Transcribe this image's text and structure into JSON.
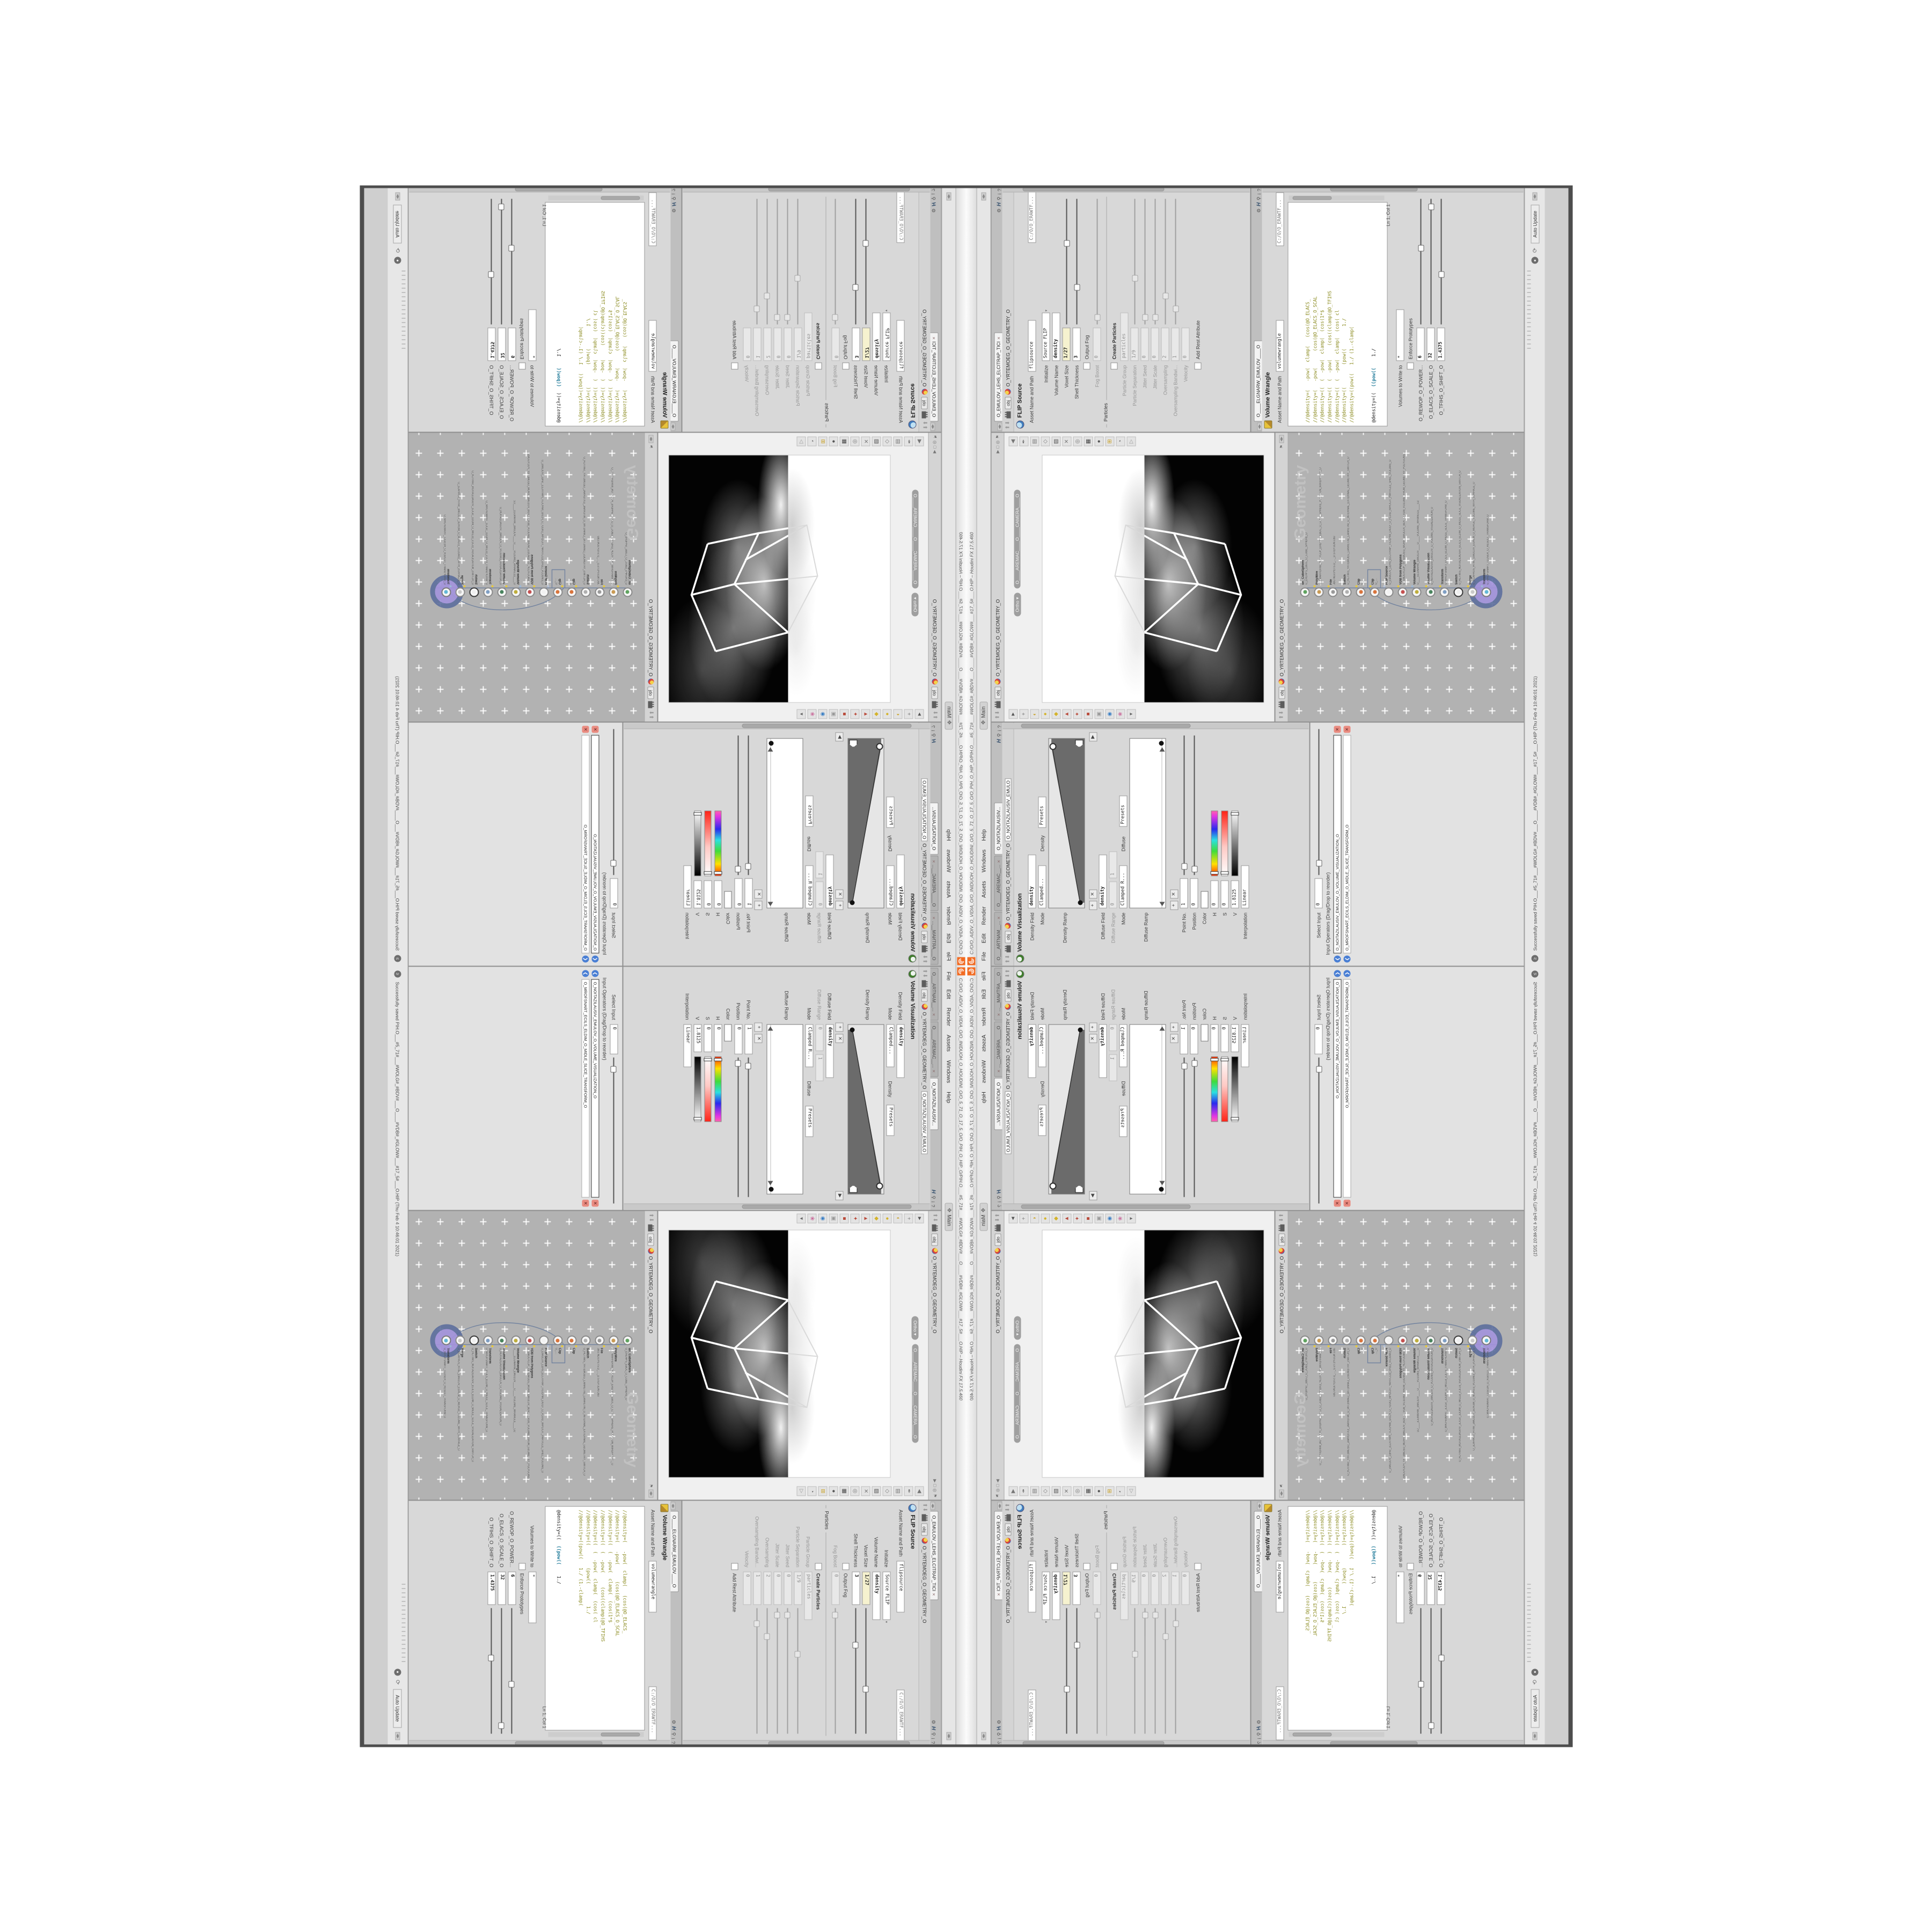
{
  "window": {
    "title": "C:/O/O_AIDIV_O_VIDIA_O/O_INIDUOH_O_HOUDINI_O/O_5_71_O_17_5_O/O_PIH_O_HIP_O/PIH.O___#5_71#___#WOLG#_#BDV#___O____#VDB#_#GLOW#___#17_5#___O.HIP – Houdini FX 17.5.460",
    "menu": [
      "File",
      "Edit",
      "Render",
      "Assets",
      "Windows",
      "Help"
    ],
    "desktop": "Main"
  },
  "status": {
    "message": "Successfully saved PIH.O___#5_71#___#WOLG#_#BDV#___O____#VDB#_#GLOW#___#17_5#___O.HIP (Thu Feb 4 10:46:01 2021)",
    "auto_update": "Auto Update"
  },
  "scene": {
    "context_tab": "obj",
    "path": "O_YRTEMOEG_O_GEOMETRY_O",
    "view_mode": "Ortho",
    "camera": "O____AREMAC____O____CAMERA____O"
  },
  "network": {
    "context_tab": "obj",
    "path": "O_YRTEMOEG_O_GEOMETRY_O",
    "watermark": "Geometry",
    "nodes": [
      {
        "t": "un_CubeSphere",
        "n": "O_EREHPS_EBUC_O_CUBE_SPHERE_O",
        "c": "#5fa35f",
        "ring": "#8a8a8a",
        "badge": "transparent"
      },
      {
        "t": "PolyWire",
        "n": "O_EMARFERIW_NOGYLOP_EREHPS_EBUC_O_CUBE_SPHERE_POLYGON_WIREFRAME_O",
        "c": "#c99a53",
        "ring": "#8a8a8a",
        "badge": "#e8c93a"
      },
      {
        "t": "File",
        "n": "JBO.ND3.PETS.D_…_D.STEP.3DN.OBJ",
        "c": "#9a9a9a",
        "ring": "#8a8a8a",
        "badge": "#e8c93a"
      },
      {
        "t": "Switch",
        "n": "O_HCTIWS_YRTEMOEG_LANRETXE_LANRETNI_O_INTERNAL_EXTERNAL_GEOMETRY_SWITCH_O",
        "c": "#b0b0b0",
        "ring": "#8a8a8a",
        "badge": "transparent"
      },
      {
        "t": "Clip",
        "n": "O_…",
        "c": "#d9743c",
        "ring": "#8a8a8a",
        "badge": "#e8c93a"
      },
      {
        "t": "Clip",
        "n": "O_…",
        "c": "#d9743c",
        "ring": "#8a8a8a",
        "badge": "#e8c93a"
      },
      {
        "t": "FLIP Source",
        "n": "O_EMULOV_LEHS_ELCITRAP_TICILPMI_DIULF_O_FLUID_IMPLICIT_PARTICLE_SHEL_VOLUME_O",
        "c": "#f2f2f2",
        "ring": "#8a8a8a",
        "badge": "#b8c4d8"
      },
      {
        "t": "VDB from Polygons",
        "n": "O_SNOGYLOP_YRTEMOEG_MORF_EMULOV_BDV_O_VDB_VOLUME_FROM_GEOMETRY_POLYGONS_O",
        "c": "#c45050",
        "ring": "#8a8a8a",
        "badge": "#e8c93a"
      },
      {
        "t": "Volume Wrangle",
        "n": "O____ELGNARW_EMULOV____O____VOLUME_WRANGLE____O2",
        "c": "#bfae3c",
        "ring": "#8a8a8a",
        "badge": "#9db8d6"
      },
      {
        "t": "Volume Visualization",
        "n": "O_NOITAZILAUSIV_EMULOV_O_VOLUME_VISUALIZATION_O",
        "c": "#49845e",
        "ring": "#8a8a8a",
        "badge": "#e8c93a"
      },
      {
        "t": "Transform",
        "n": "O_MROFSNART_ECILS_ELDIM_O_MIDLE_SLICE_TRANSFORM_O",
        "c": "#7f9fc4",
        "ring": "#8a8a8a",
        "badge": "#e8c93a"
      },
      {
        "t": "Switch",
        "n": "O_HCTIWS_NOITAZILAUSIV_ECILS_ELDIM_O_MIDLE_SLICE_VISUALIZATION_SWITCH_O",
        "c": "#efefef",
        "ring": "#3a3a3a",
        "badge": "transparent"
      },
      {
        "t": "Merge",
        "n": "O_ECAFRUS_HTIW_EMULOV_EGREM_O_MERGE_VOLUME_WITH_SURFACE_O",
        "c": "#c9c9c9",
        "ring": "#8a8a8a",
        "badge": "#e8c93a"
      },
      {
        "t": "Transform",
        "n": "O_MROFSNART_TLUSER_O_RESULT_TRANSFORM_O",
        "c": "#63b8d8",
        "ring": "#7a7a7a",
        "badge": "#9db8d6"
      }
    ]
  },
  "flip": {
    "tab": "O_EMULOV_LEHS_ELCITRAP_TICI",
    "context_tab": "obj",
    "path": "O_YRTEMOEG_O_GEOMETRY_O",
    "title": "FLIP Source",
    "asset_label": "Asset Name and Path",
    "asset_name": "flipsource",
    "asset_path": "C:/O/O_ERAWTF...",
    "initialize_label": "Initialize",
    "initialize_value": "Source FLIP",
    "volume_name_label": "Volume Name",
    "volume_name_value": "density",
    "voxel_label": "Voxel Size",
    "voxel_value": "1/27",
    "shell_label": "Shell Thickness",
    "shell_value": "3",
    "output_fog_label": "Output Fog",
    "fog_boost_label": "Fog Boost",
    "fog_boost_value": "0",
    "particles_section": "Particles",
    "create_particles_label": "Create Particles",
    "particle_group_label": "Particle Group",
    "particle_group_value": "particles",
    "particle_separation_label": "Particle Separation",
    "particle_separation_value": "1/9",
    "jitter_seed_label": "Jitter Seed",
    "jitter_seed_value": "0",
    "jitter_scale_label": "Jitter Scale",
    "jitter_scale_value": "0",
    "oversampling_label": "Oversampling",
    "oversampling_value": "2",
    "oversampling_bw_label": "Oversampling Bandwi...",
    "oversampling_bw_value": "1",
    "velocity_label": "Velocity",
    "velocity_value": "0",
    "add_rest_label": "Add Rest Attribute"
  },
  "wrangle": {
    "tab": "O____ELGNARW_EMULOV____O",
    "title": "Volume Wrangle",
    "asset_label": "Asset Name and Path",
    "asset_name": "volumewrangle",
    "asset_path": "C:/O/O_ERAWTF...",
    "code": [
      "//@density=(   -pow(  clamp(   (cos(@O_ELACS_",
      "//@density=(   -pow(      (cos(@O_ELACS_O_SCAL",
      "//@density=((  (  -pow(  clamp(  (cos(1*$",
      "//@density=((  (  -pow(     (cos((clamp(@O_TFIHS",
      "//@density=((  (  -pow(  clamp(  (cos( cl",
      "//@density=((        (pow((        1./",
      "//@density=((pow((   1./ (1.-clamp("
    ],
    "active_prefix": "@density=((  ",
    "active_pow": "((pow((",
    "active_tail": "    1./",
    "ln": "Ln 1, Col 1",
    "volumes_label": "Volumes to Write to",
    "volumes_value": "*",
    "enforce_label": "Enforce Prototypes",
    "power_label": "O_REWOP_O_POWER...",
    "power_value": "6",
    "scale_label": "O_ELACS_O_SCALE_O",
    "scale_value": "32",
    "shift_label": "O_TFIHS_O_SHIFT_O",
    "shift_value": "1.4375"
  },
  "volviz": {
    "tab1": "O___ARTNAM__...",
    "tab2": "O____AREMAC__...",
    "tab3": "O_NOITAZILAUSIV...",
    "context_tab": "obj",
    "path": "O_YRTEMOEG_O_GEOMETRY_O",
    "node_field": "O_NOITAZILAUSIV_EMULO",
    "title": "Volume Visualization",
    "density_field_label": "Density Field",
    "density_field_value": "density",
    "mode_label": "Mode",
    "mode_value": "Clamped...",
    "ramp_title": "Density",
    "presets_label": "Presets",
    "density_ramp_label": "Density Ramp",
    "diffuse_field_label": "Diffuse Field",
    "diffuse_field_value": "density",
    "diffuse_range_label": "Diffuse Range",
    "diffuse_range_0": "0",
    "diffuse_range_1": "1",
    "mode2_value": "Clamped R...",
    "ramp2_title": "Diffuse",
    "diffuse_ramp_label": "Diffuse Ramp",
    "point_label": "Point No.",
    "point_value": "1",
    "pos_label": "Position",
    "pos_value": "0",
    "color_label": "Color",
    "h_label": "H",
    "h_value": "0",
    "s_label": "S",
    "s_value": "0",
    "v_label": "V",
    "v_value": "1.8125",
    "interp_label": "Interpolation",
    "interp_value": "Linear"
  },
  "switch_pane": {
    "select_label": "Select Input",
    "select_value": "0",
    "ops_label": "Input Operators (Drag/Drop to reorder)",
    "op1": "O_NOITAZILAUSIV_EMULOV_O_VOLUME_VISUALIZATION_O",
    "op2": "O_MROFSNART_ECILS_ELDIM_O_MIDLE_SLICE_TRANSFORM_O"
  },
  "vp_left_icons": [
    {
      "g": "►",
      "c": "#555555"
    },
    {
      "g": "+",
      "c": "#777777"
    },
    {
      "g": "◐",
      "c": "#c9a227"
    },
    {
      "g": "●",
      "c": "#d4b32a"
    },
    {
      "g": "◆",
      "c": "#d4b32a"
    },
    {
      "g": "▲",
      "c": "#b94a3a"
    },
    {
      "g": "✦",
      "c": "#b94a3a"
    },
    {
      "g": "■",
      "c": "#b94a3a"
    },
    {
      "g": "▣",
      "c": "#9a9a9a"
    },
    {
      "g": "◉",
      "c": "#3b7fc4"
    },
    {
      "g": "❀",
      "c": "#c96a9a"
    },
    {
      "g": "▾",
      "c": "#666666"
    }
  ],
  "vp_right_icons": [
    {
      "g": "◀",
      "c": "#777777"
    },
    {
      "g": "✒",
      "c": "#777777"
    },
    {
      "g": "▤",
      "c": "#777777"
    },
    {
      "g": "◇",
      "c": "#777777"
    },
    {
      "g": "▨",
      "c": "#555555"
    },
    {
      "g": "✕",
      "c": "#777777"
    },
    {
      "g": "◎",
      "c": "#777777"
    },
    {
      "g": "▦",
      "c": "#444444"
    },
    {
      "g": "●",
      "c": "#555555"
    },
    {
      "g": "⊞",
      "c": "#c9a227",
      "hl": true
    },
    {
      "g": "◔",
      "c": "#555555"
    },
    {
      "g": "▷",
      "c": "#999999"
    }
  ],
  "colors": {
    "houdini_orange": "#f26b22",
    "network_bg": "#b2b2b2",
    "selection_halo": "#a393dd",
    "halo_ring": "#5d6f9e",
    "vex_olive": "#8b8b20",
    "vex_teal": "#1f7a99",
    "field_highlight": "#f6f2cf"
  }
}
